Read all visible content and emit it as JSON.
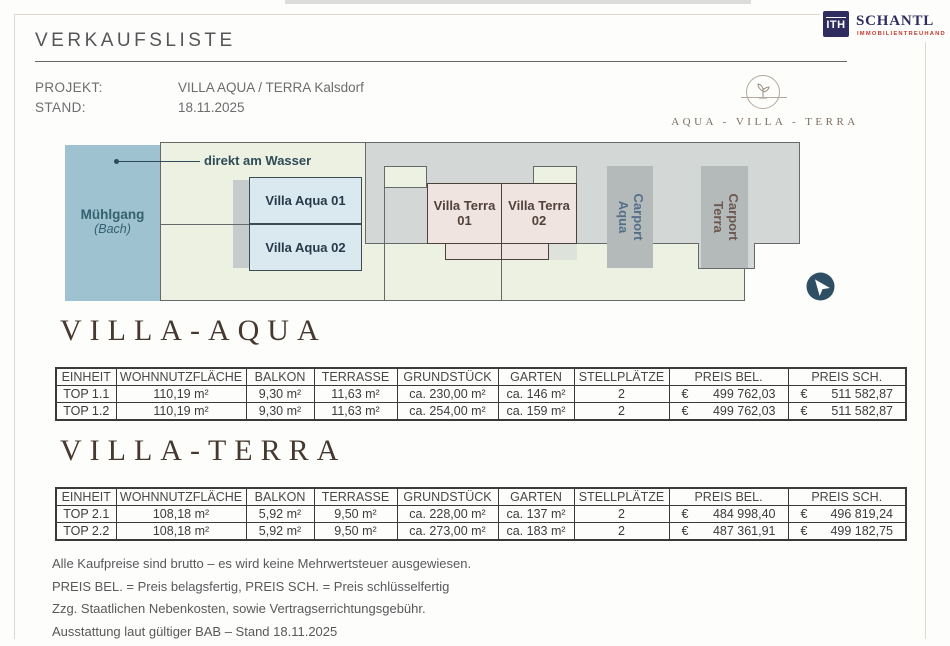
{
  "brand": {
    "logo_text": "ITH",
    "name": "SCHANTL",
    "subtitle": "IMMOBILIENTREUHAND",
    "navy": "#2f2d5f",
    "red": "#c23b30"
  },
  "header": {
    "title": "VERKAUFSLISTE",
    "project_label": "PROJEKT:",
    "project_value": "VILLA AQUA / TERRA Kalsdorf",
    "stand_label": "STAND:",
    "stand_value": "18.11.2025"
  },
  "estate_logo": {
    "caption": "AQUA - VILLA - TERRA"
  },
  "site_plan": {
    "water": {
      "name": "Mühlgang",
      "sub": "(Bach)"
    },
    "water_note": "direkt am Wasser",
    "villa_aqua_01": "Villa Aqua 01",
    "villa_aqua_02": "Villa Aqua 02",
    "villa_terra_01": {
      "line1": "Villa Terra",
      "line2": "01"
    },
    "villa_terra_02": {
      "line1": "Villa Terra",
      "line2": "02"
    },
    "carport_aqua": {
      "line1": "Carport",
      "line2": "Aqua"
    },
    "carport_terra": {
      "line1": "Carport",
      "line2": "Terra"
    },
    "colors": {
      "water": "#9fc2d1",
      "parcel_green": "#ecf1e2",
      "gray_zone": "#d3d7d6",
      "carport_gray": "#b4b9ba",
      "villa_aqua_fill": "#dae8f0",
      "villa_terra_fill": "#efe4df",
      "compass": "#2d4e63"
    }
  },
  "tables": [
    {
      "title": "VILLA-AQUA",
      "columns": [
        "EINHEIT",
        "WOHNNUTZFLÄCHE",
        "BALKON",
        "TERRASSE",
        "GRUNDSTÜCK",
        "GARTEN",
        "STELLPLÄTZE",
        "PREIS BEL.",
        "PREIS SCH."
      ],
      "rows": [
        {
          "einheit": "TOP 1.1",
          "wohnnutzflaeche": "110,19 m²",
          "balkon": "9,30 m²",
          "terrasse": "11,63 m²",
          "grundstueck": "ca. 230,00 m²",
          "garten": "ca. 146 m²",
          "stellplaetze": "2",
          "preis_bel_cur": "€",
          "preis_bel": "499 762,03",
          "preis_sch_cur": "€",
          "preis_sch": "511 582,87"
        },
        {
          "einheit": "TOP 1.2",
          "wohnnutzflaeche": "110,19 m²",
          "balkon": "9,30 m²",
          "terrasse": "11,63 m²",
          "grundstueck": "ca. 254,00 m²",
          "garten": "ca. 159 m²",
          "stellplaetze": "2",
          "preis_bel_cur": "€",
          "preis_bel": "499 762,03",
          "preis_sch_cur": "€",
          "preis_sch": "511 582,87"
        }
      ]
    },
    {
      "title": "VILLA-TERRA",
      "columns": [
        "EINHEIT",
        "WOHNNUTZFLÄCHE",
        "BALKON",
        "TERRASSE",
        "GRUNDSTÜCK",
        "GARTEN",
        "STELLPLÄTZE",
        "PREIS BEL.",
        "PREIS SCH."
      ],
      "rows": [
        {
          "einheit": "TOP 2.1",
          "wohnnutzflaeche": "108,18 m²",
          "balkon": "5,92 m²",
          "terrasse": "9,50 m²",
          "grundstueck": "ca. 228,00 m²",
          "garten": "ca. 137 m²",
          "stellplaetze": "2",
          "preis_bel_cur": "€",
          "preis_bel": "484 998,40",
          "preis_sch_cur": "€",
          "preis_sch": "496 819,24"
        },
        {
          "einheit": "TOP 2.2",
          "wohnnutzflaeche": "108,18 m²",
          "balkon": "5,92 m²",
          "terrasse": "9,50 m²",
          "grundstueck": "ca. 273,00 m²",
          "garten": "ca. 183 m²",
          "stellplaetze": "2",
          "preis_bel_cur": "€",
          "preis_bel": "487 361,91",
          "preis_sch_cur": "€",
          "preis_sch": "499 182,75"
        }
      ]
    }
  ],
  "footnotes": [
    "Alle Kaufpreise sind brutto – es wird keine Mehrwertsteuer ausgewiesen.",
    "PREIS BEL. = Preis belagsfertig, PREIS SCH. = Preis schlüsselfertig",
    "Zzg. Staatlichen Nebenkosten, sowie Vertragserrichtungsgebühr.",
    "Ausstattung laut gültiger BAB – Stand 18.11.2025"
  ]
}
